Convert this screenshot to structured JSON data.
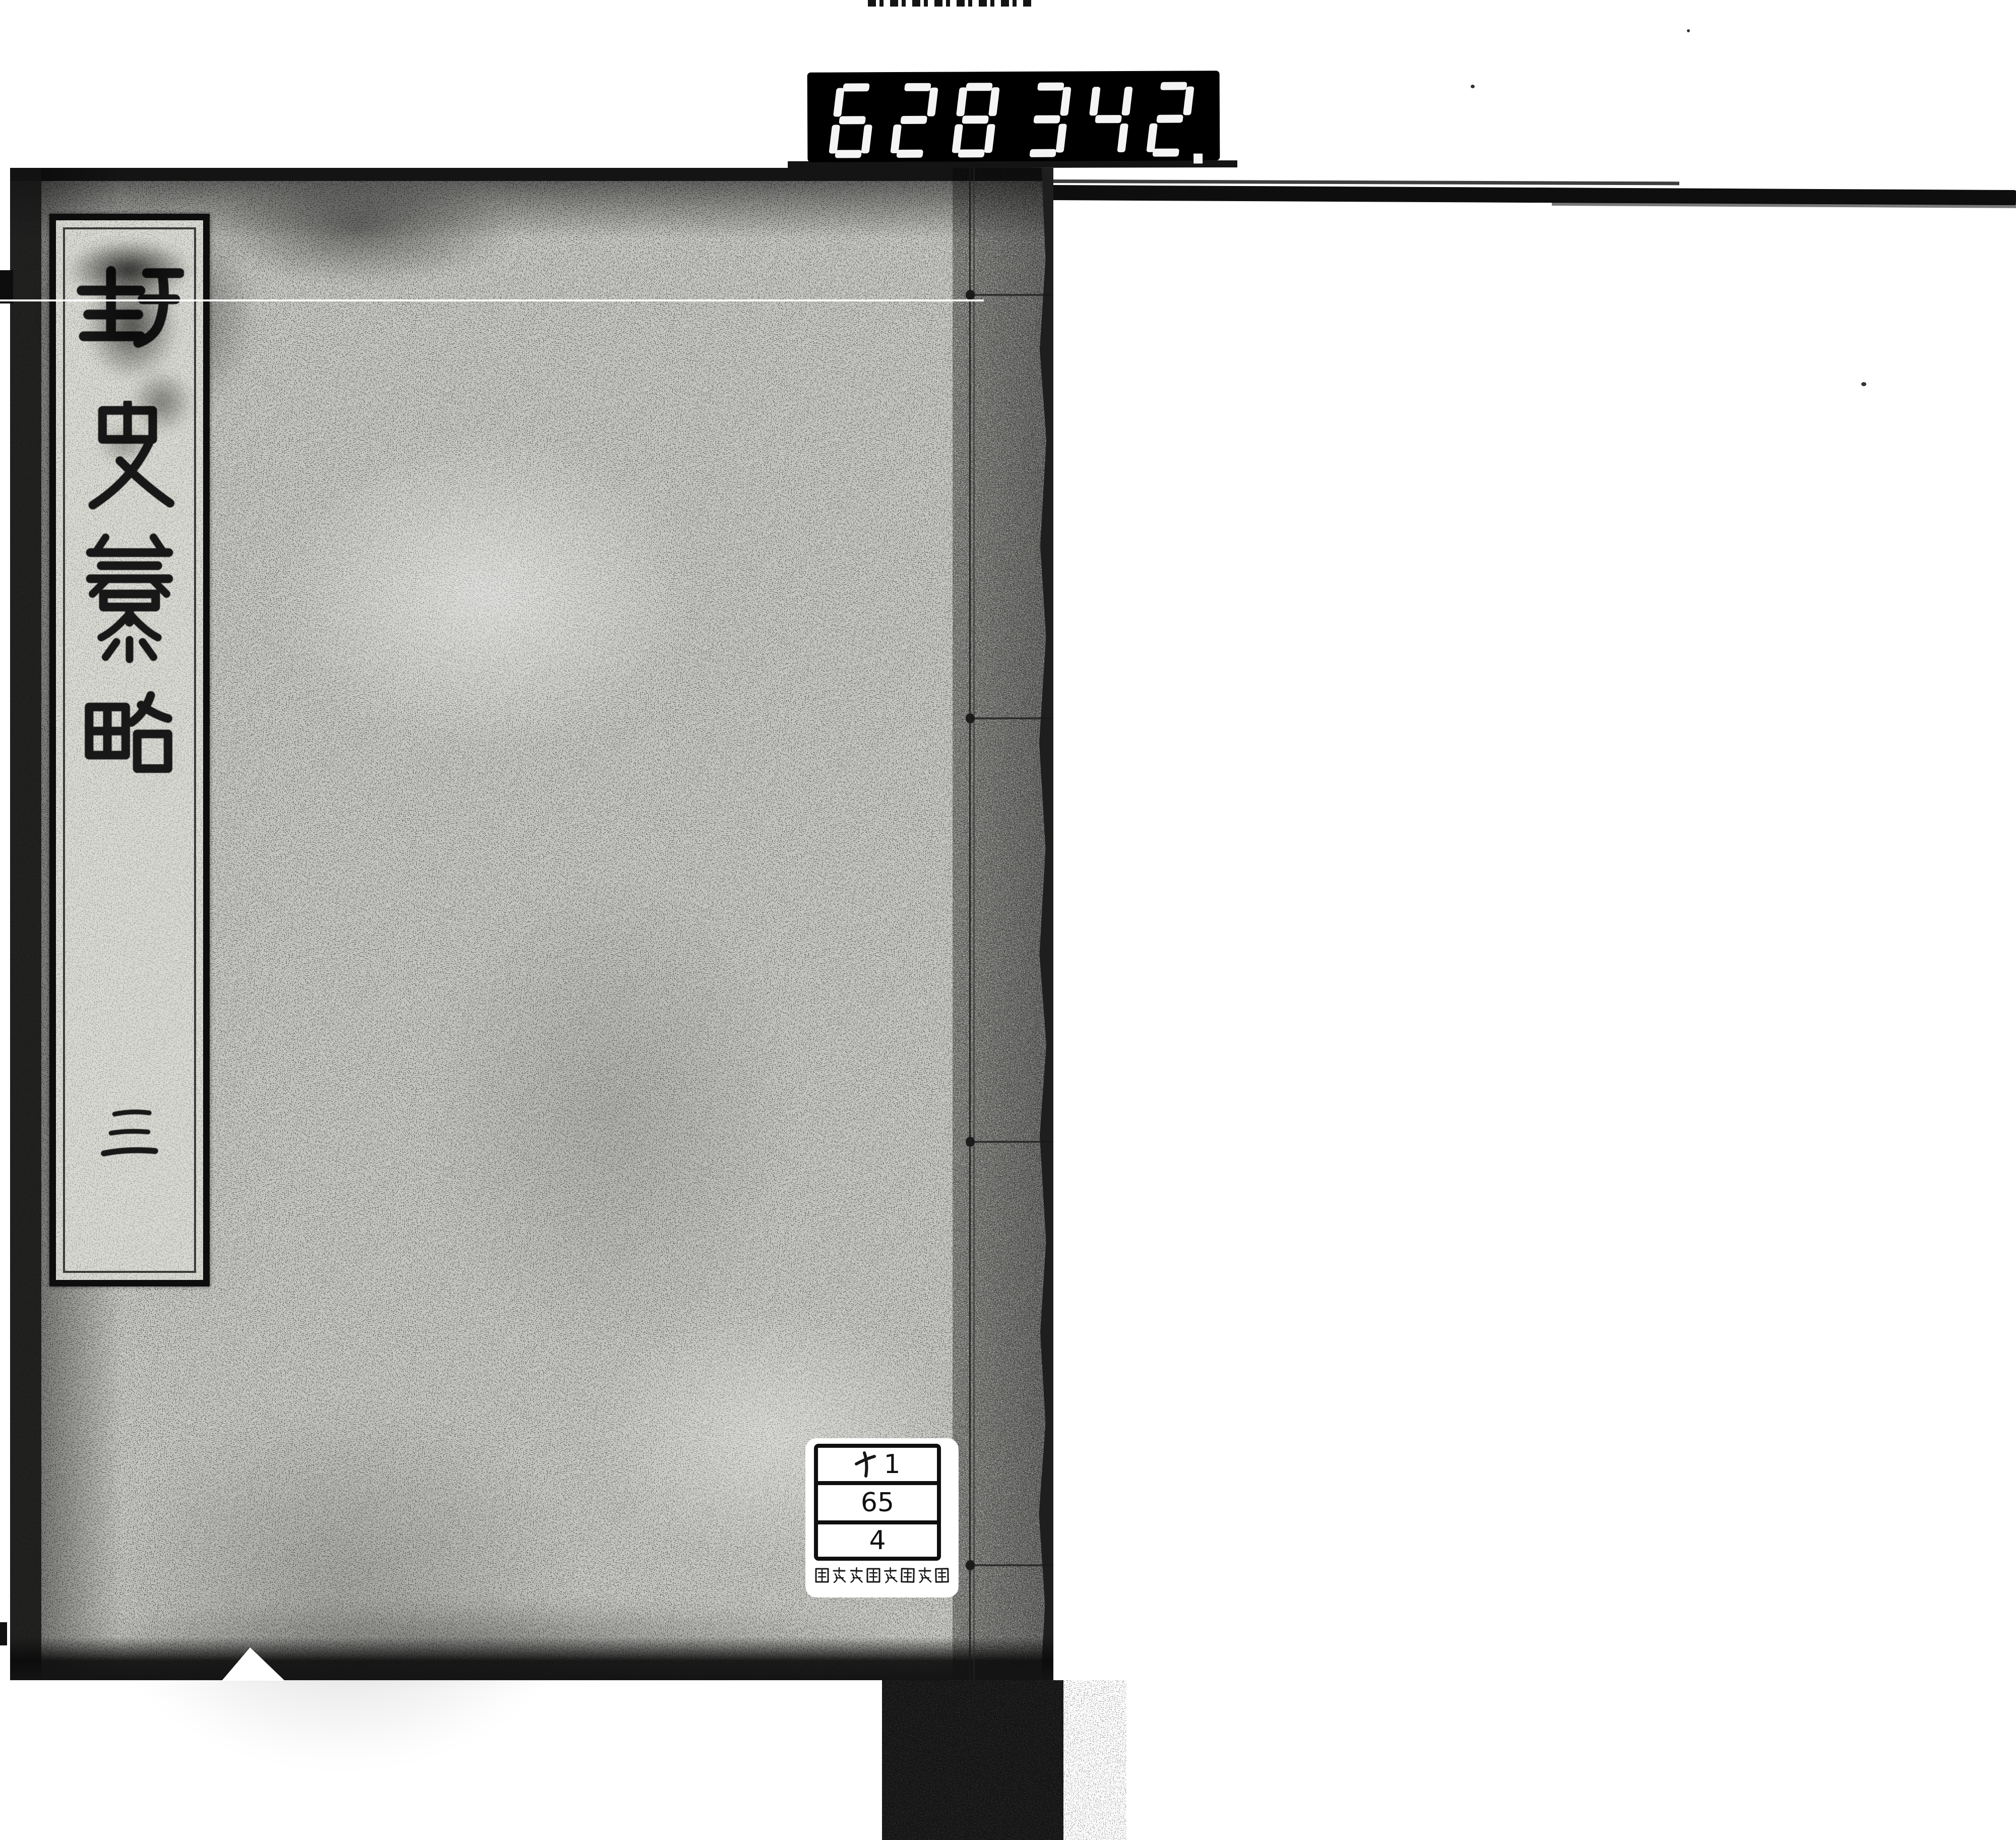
{
  "counter": {
    "left_digits": "628",
    "right_digits": "342",
    "decimal_point": "."
  },
  "cover": {
    "title_slip": {
      "title": "野史纂略",
      "characters": [
        "野",
        "史",
        "纂",
        "略"
      ],
      "volume_label": "三"
    }
  },
  "library_label": {
    "call_number": {
      "line1_kana": "ヤ",
      "line1_number": "1",
      "line2": "65",
      "line3": "4"
    },
    "institution": "国文学研究資料館"
  },
  "colors": {
    "counter_bg": "#000000",
    "counter_digits": "#f4f4f4",
    "cover_gray": "#c7c7c3",
    "slip_bg": "#dadad4",
    "label_bg": "#ffffff",
    "ink": "#181818"
  }
}
